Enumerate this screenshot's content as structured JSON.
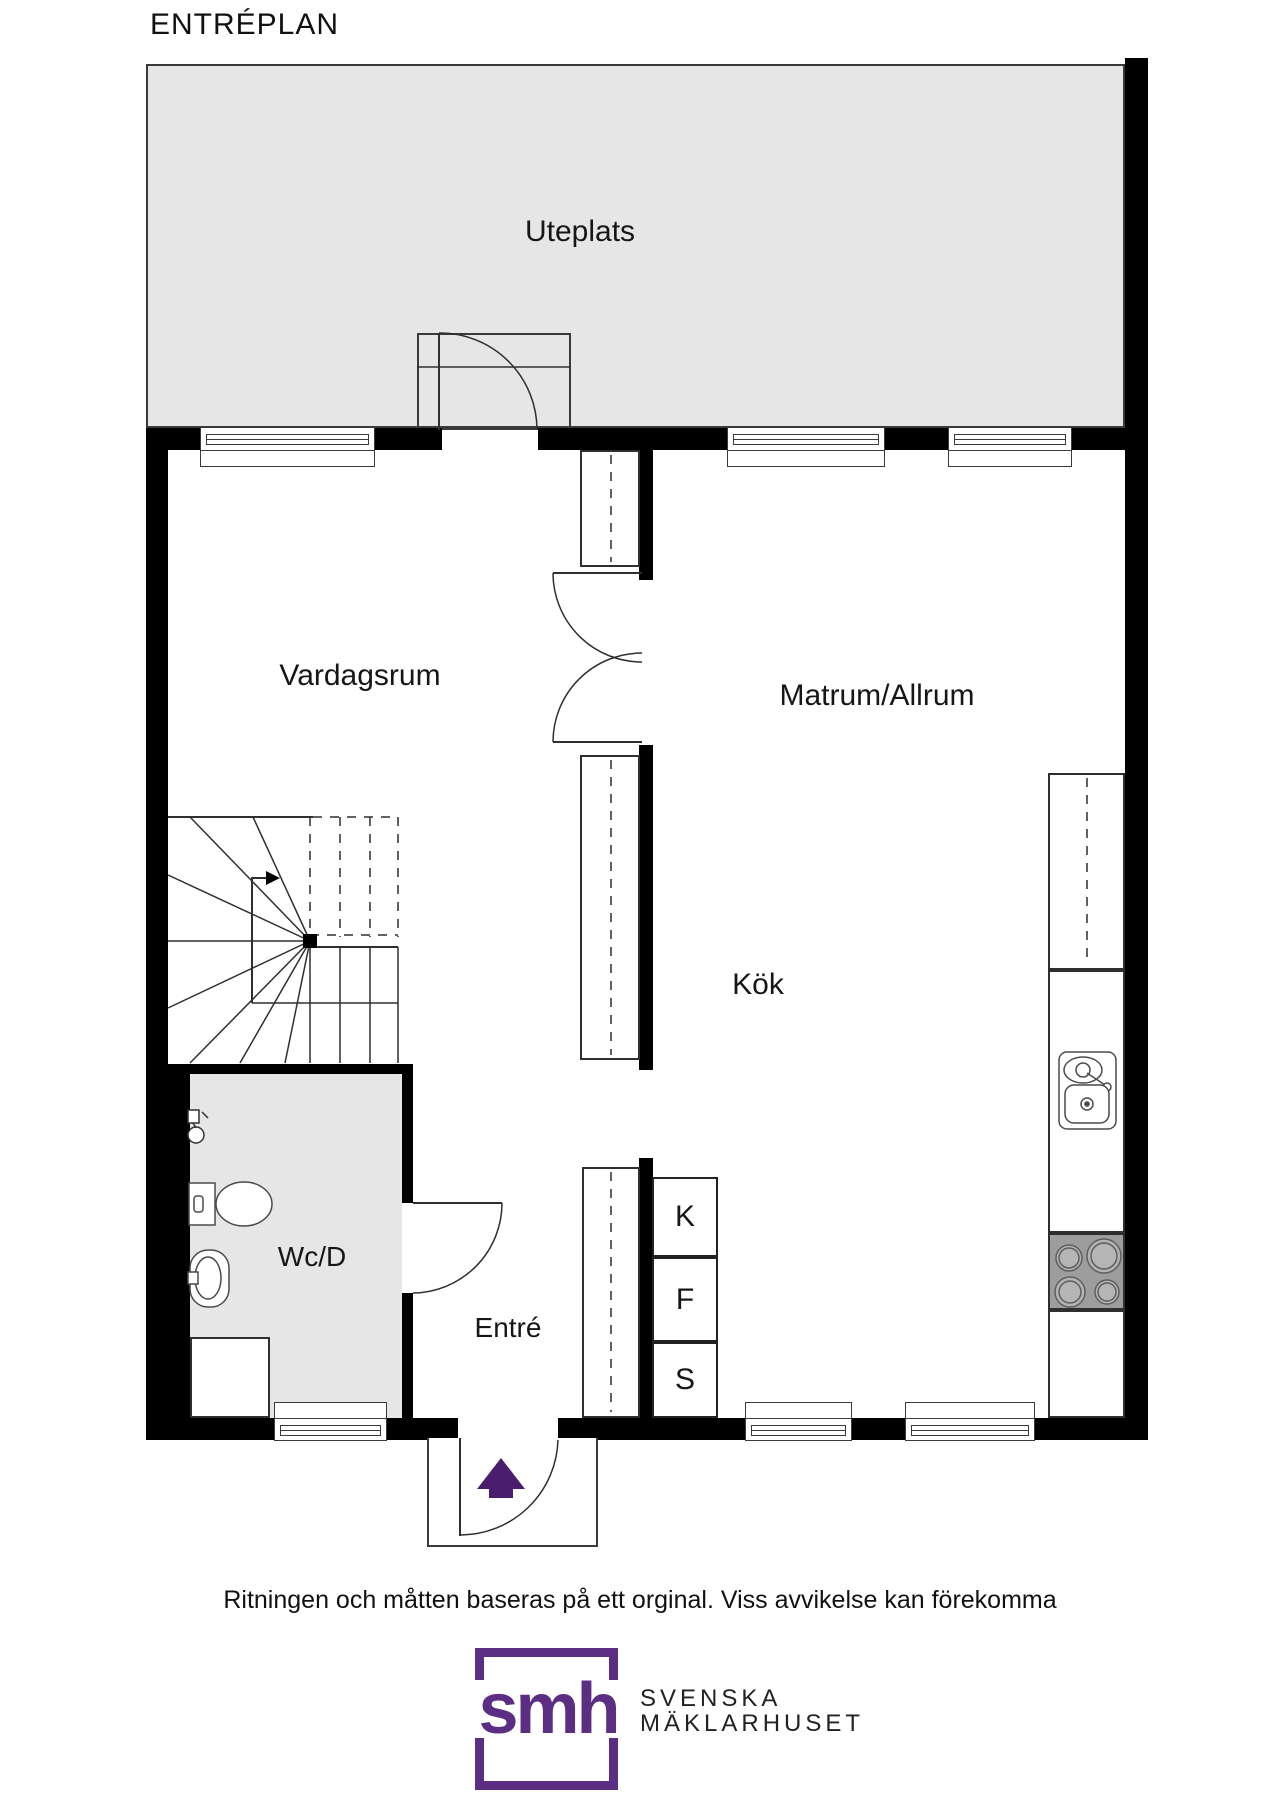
{
  "title": "ENTRÉPLAN",
  "rooms": {
    "uteplats": "Uteplats",
    "vardagsrum": "Vardagsrum",
    "matrum": "Matrum/Allrum",
    "kok": "Kök",
    "wcd": "Wc/D",
    "entre": "Entré"
  },
  "appliances": {
    "k": "K",
    "f": "F",
    "s": "S"
  },
  "disclaimer": "Ritningen och måtten baseras på ett orginal. Viss avvikelse kan förekomma",
  "logo": {
    "monogram": "smh",
    "line1": "SVENSKA",
    "line2": "MÄKLARHUSET"
  },
  "colors": {
    "accent": "#5b2d83",
    "arrow": "#4a1d6f",
    "wall": "#000000",
    "area": "#e6e6e6",
    "stove": "#9d9d9d",
    "line": "#3a3a3a"
  },
  "fixtures": [
    "stairs",
    "toilet",
    "hand-sink",
    "shower",
    "kitchen-sink",
    "stove-burners",
    "entrance-arrow"
  ]
}
